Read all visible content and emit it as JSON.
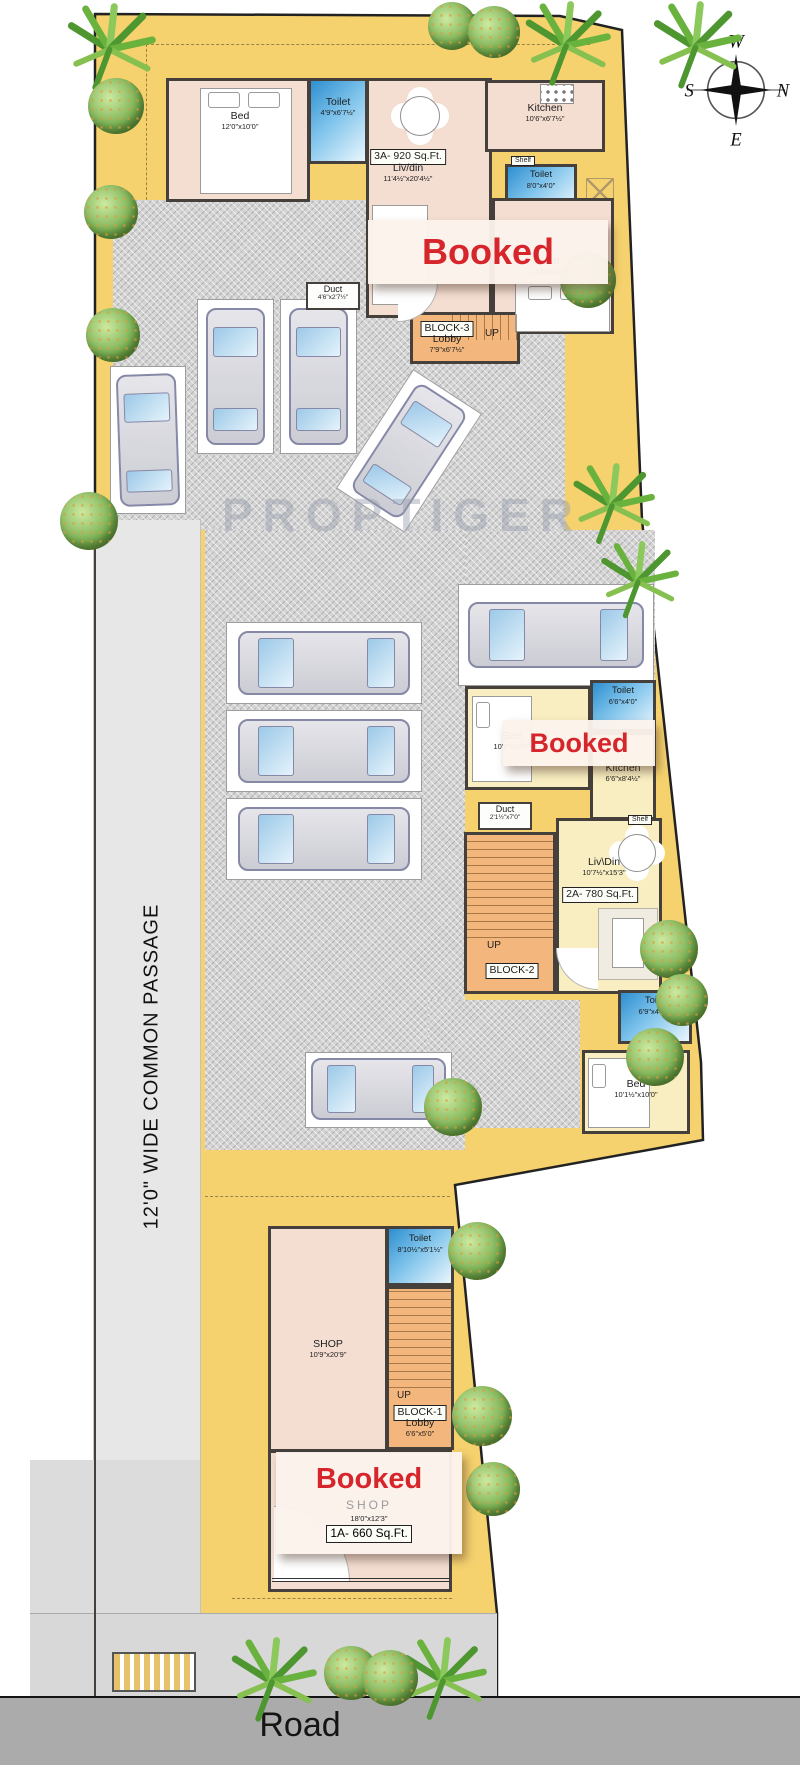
{
  "wm": "PROPTIGER",
  "road": {
    "label": "Road"
  },
  "passage": {
    "label": "12'0\"   WIDE COMMON PASSAGE"
  },
  "compass": {
    "north": "N",
    "south": "S",
    "east": "E",
    "west": "W"
  },
  "colors": {
    "plot": "#f6d26e",
    "toilet_blue": "#3d9ad8",
    "stair_orange": "#f3b77d",
    "room_pink": "#f4ded2",
    "room_yellow": "#f8eec2",
    "booked_red": "#d6252b"
  },
  "b3": {
    "area": "3A- 920 Sq.Ft.",
    "bed1": {
      "name": "Bed",
      "dims": "12'0\"x10'0\""
    },
    "toilet1": {
      "name": "Toilet",
      "dims": "4'9\"x6'7½\""
    },
    "livdin": {
      "name": "Liv/din",
      "dims": "11'4½\"x20'4½\""
    },
    "kitchen": {
      "name": "Kitchen",
      "dims": "10'6\"x6'7½\""
    },
    "shelf": "Shelf",
    "toilet2": {
      "name": "Toilet",
      "dims": "8'0\"x4'0\""
    },
    "booked": "Booked",
    "bed2": {
      "name": "Bed",
      "dims": "11'9\"x10'0\""
    },
    "duct": {
      "name": "Duct",
      "dims": "4'6\"x2'7½\""
    },
    "block": "BLOCK-3",
    "lobby": "Lobby",
    "lobby_dims": "7'9\"x6'7½\"",
    "up": "UP"
  },
  "b2": {
    "area": "2A- 780 Sq.Ft.",
    "toilet1": {
      "name": "Toilet",
      "dims": "6'6\"x4'0\""
    },
    "bed1": {
      "name": "Bed",
      "dims": "10'9\"x10'0\""
    },
    "booked": "Booked",
    "kitchen": {
      "name": "Kitchen",
      "dims": "6'6\"x8'4½\""
    },
    "duct": {
      "name": "Duct",
      "dims": "2'1½\"x7'0\""
    },
    "shelf": "Shelf",
    "livdin": {
      "name": "Liv\\Din",
      "dims": "10'7½\"x15'3\""
    },
    "up": "UP",
    "block": "BLOCK-2",
    "toilet2": {
      "name": "Toilet",
      "dims": "6'9\"x4'4½\""
    },
    "bed2": {
      "name": "Bed",
      "dims": "10'1½\"x10'0\""
    }
  },
  "b1": {
    "area": "1A- 660 Sq.Ft.",
    "toilet": {
      "name": "Toilet",
      "dims": "8'10½\"x5'1½\""
    },
    "shop1": {
      "name": "SHOP",
      "dims": "10'9\"x20'9\""
    },
    "up": "UP",
    "block": "BLOCK-1",
    "lobby": "Lobby",
    "lobby_dims": "6'6\"x5'0\"",
    "booked": "Booked",
    "shop2": {
      "name": "SHOP",
      "dims": "18'0\"x12'3\""
    }
  }
}
